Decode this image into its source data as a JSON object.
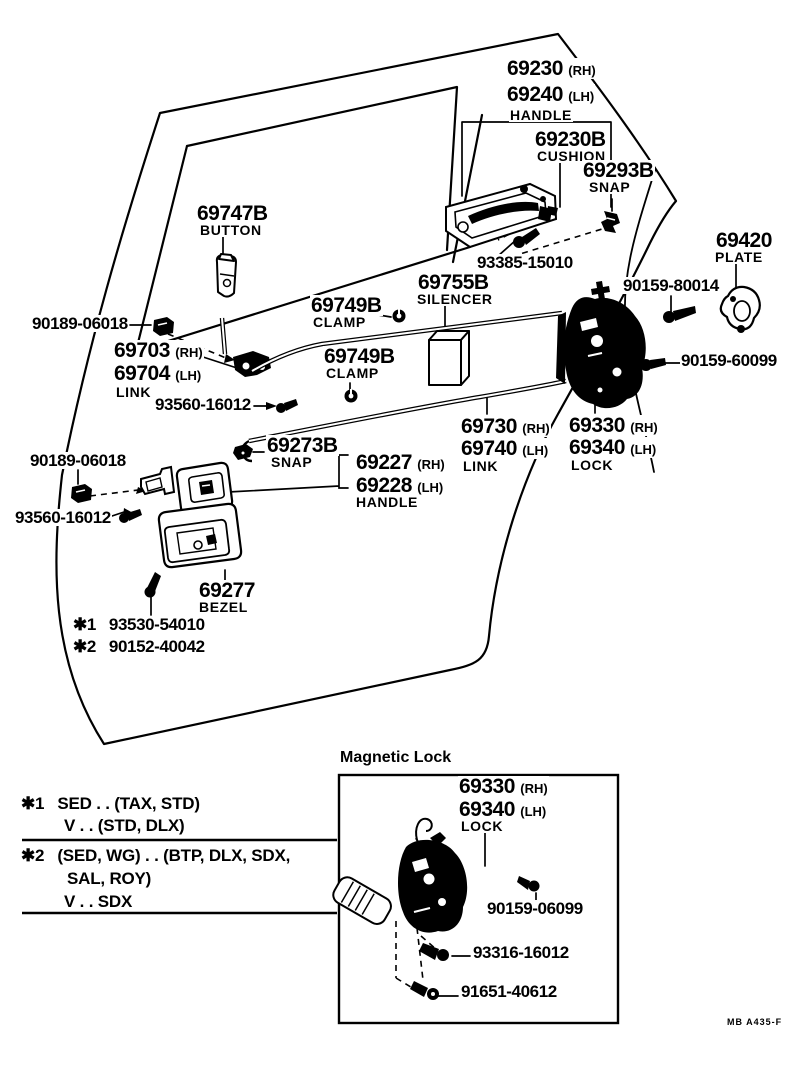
{
  "labels": {
    "n69230": {
      "num": "69230",
      "sfx": "(RH)"
    },
    "n69240": {
      "num": "69240",
      "sfx": "(LH)"
    },
    "w_handle1": "HANDLE",
    "n69230B": {
      "num": "69230B"
    },
    "w_cushion": "CUSHION",
    "n69293B": {
      "num": "69293B"
    },
    "w_snap1": "SNAP",
    "n69747B": {
      "num": "69747B"
    },
    "w_button": "BUTTON",
    "c93385": "93385-15010",
    "n69755B": {
      "num": "69755B"
    },
    "w_silencer": "SILENCER",
    "n69420": {
      "num": "69420"
    },
    "w_plate": "PLATE",
    "c90159_80014": "90159-80014",
    "n69749B_1": {
      "num": "69749B"
    },
    "w_clamp1": "CLAMP",
    "c90189_1": "90189-06018",
    "n69703": {
      "num": "69703",
      "sfx": "(RH)"
    },
    "n69704": {
      "num": "69704",
      "sfx": "(LH)"
    },
    "w_link1": "LINK",
    "n69749B_2": {
      "num": "69749B"
    },
    "w_clamp2": "CLAMP",
    "c90159_60099": "90159-60099",
    "c93560_1": "93560-16012",
    "n69730": {
      "num": "69730",
      "sfx": "(RH)"
    },
    "n69740": {
      "num": "69740",
      "sfx": "(LH)"
    },
    "w_link2": "LINK",
    "n69330": {
      "num": "69330",
      "sfx": "(RH)"
    },
    "n69340": {
      "num": "69340",
      "sfx": "(LH)"
    },
    "w_lock1": "LOCK",
    "c90189_2": "90189-06018",
    "n69273B": {
      "num": "69273B"
    },
    "w_snap2": "SNAP",
    "n69227": {
      "num": "69227",
      "sfx": "(RH)"
    },
    "n69228": {
      "num": "69228",
      "sfx": "(LH)"
    },
    "w_handle2": "HANDLE",
    "c93560_2": "93560-16012",
    "n69277": {
      "num": "69277"
    },
    "w_bezel": "BEZEL",
    "star1": {
      "prefix": "✱1",
      "code": "93530-54010"
    },
    "star2": {
      "prefix": "✱2",
      "code": "90152-40042"
    },
    "inset_title": "Magnetic Lock",
    "n69330b": {
      "num": "69330",
      "sfx": "(RH)"
    },
    "n69340b": {
      "num": "69340",
      "sfx": "(LH)"
    },
    "w_lock2": "LOCK",
    "c90159_06099": "90159-06099",
    "c93316": "93316-16012",
    "c91651": "91651-40612"
  },
  "legend": {
    "l1_prefix": "✱1",
    "l1a": "SED . . (TAX, STD)",
    "l1b": "V . . (STD, DLX)",
    "l2_prefix": "✱2",
    "l2a": "(SED, WG) . . (BTP, DLX, SDX,",
    "l2b": "SAL, ROY)",
    "l2c": "V . . SDX"
  },
  "footer": {
    "code": "MB A435-F"
  },
  "colors": {
    "ink": "#000000",
    "paper": "#ffffff"
  }
}
